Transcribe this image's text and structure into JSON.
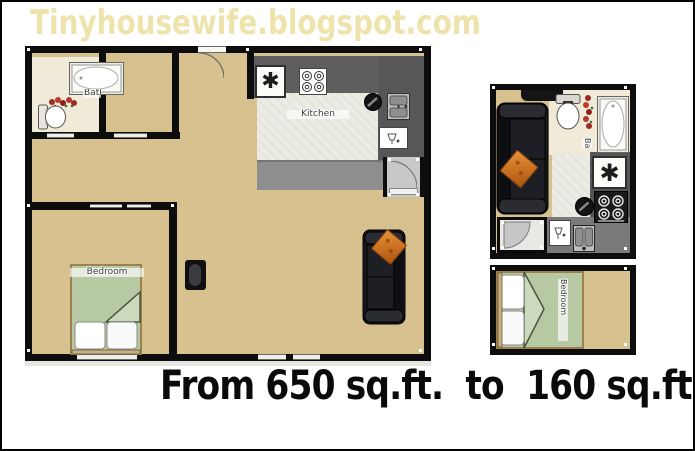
{
  "header": {
    "title": "Tinyhousewife.blogspot.com"
  },
  "caption": {
    "text": "From 650 sq.ft.  to  160 sq.ft."
  },
  "plans": {
    "large": {
      "labels": {
        "bath": "Bath",
        "kitchen": "Kitchen",
        "bedroom": "Bedroom"
      }
    },
    "small": {
      "labels": {
        "bath": "Ba",
        "bedroom": "Bedroom"
      }
    }
  },
  "icons": {
    "fridge_glyph": "✱"
  },
  "colors": {
    "title": "#EFE3AC",
    "caption": "#0A0A0A",
    "floor_tan": "#D7C28F",
    "bath_floor": "#F0EAD8",
    "wall": "#0D0D0D",
    "counter_dark": "#5E5E5E",
    "counter_light": "#8E8E8E",
    "kitchen_tile": "#ECEBE4",
    "bed_green": "#B7C9A3",
    "sofa": "#1A1C21",
    "pillow_orange": "#D2752A"
  }
}
